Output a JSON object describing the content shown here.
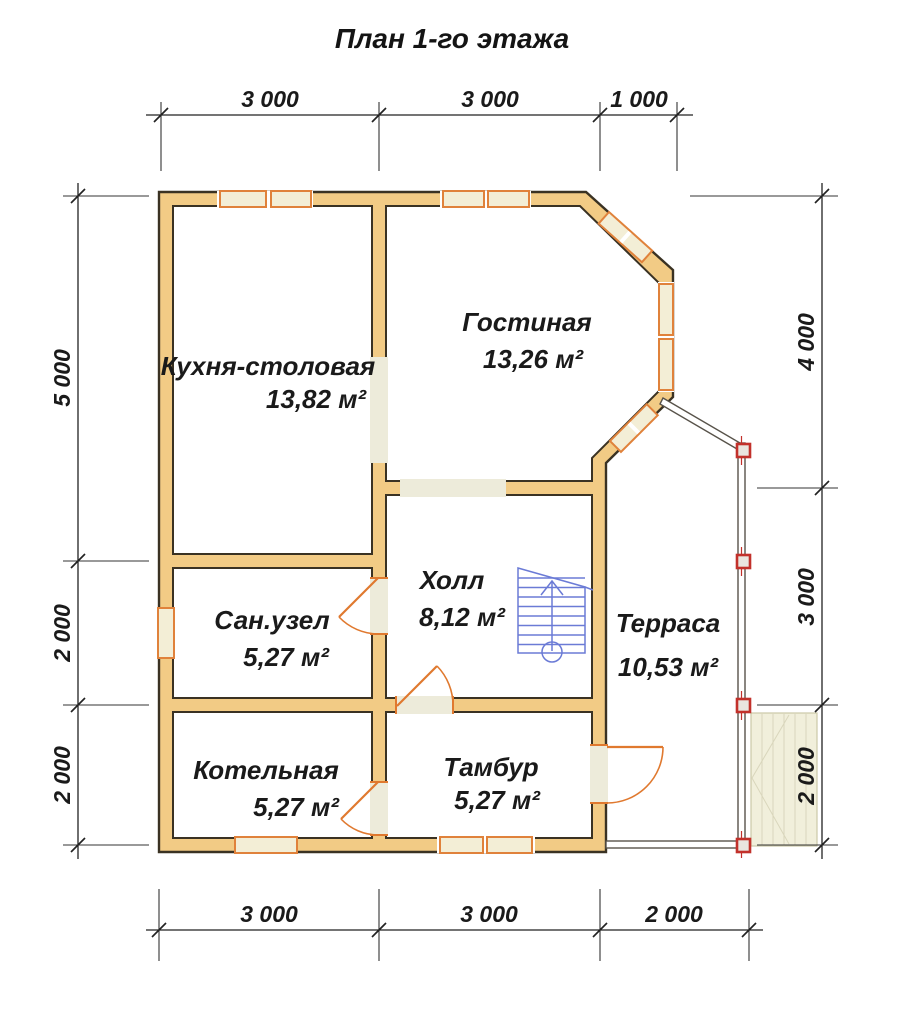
{
  "title": "План 1-го этажа",
  "rooms": {
    "kitchen": {
      "name": "Кухня-столовая",
      "area": "13,82 м²"
    },
    "living": {
      "name": "Гостиная",
      "area": "13,26 м²"
    },
    "bathroom": {
      "name": "Сан.узел",
      "area": "5,27 м²"
    },
    "hall": {
      "name": "Холл",
      "area": "8,12 м²"
    },
    "boiler": {
      "name": "Котельная",
      "area": "5,27 м²"
    },
    "vestibule": {
      "name": "Тамбур",
      "area": "5,27 м²"
    },
    "terrace": {
      "name": "Терраса",
      "area": "10,53 м²"
    }
  },
  "dimensions": {
    "top": [
      "3 000",
      "3 000",
      "1 000"
    ],
    "bottom": [
      "3 000",
      "3 000",
      "2 000"
    ],
    "left": [
      "5 000",
      "2 000",
      "2 000"
    ],
    "right": [
      "4 000",
      "3 000",
      "2 000"
    ]
  },
  "colors": {
    "wall_fill": "#F2CB85",
    "wall_outline": "#3A3223",
    "opening_fill": "#EDEBDA",
    "window_frame": "#E0823B",
    "door": "#E0792F",
    "stairs": "#6B7BD6",
    "post": "#C2312B",
    "dimension_text": "#1A1A1A"
  }
}
